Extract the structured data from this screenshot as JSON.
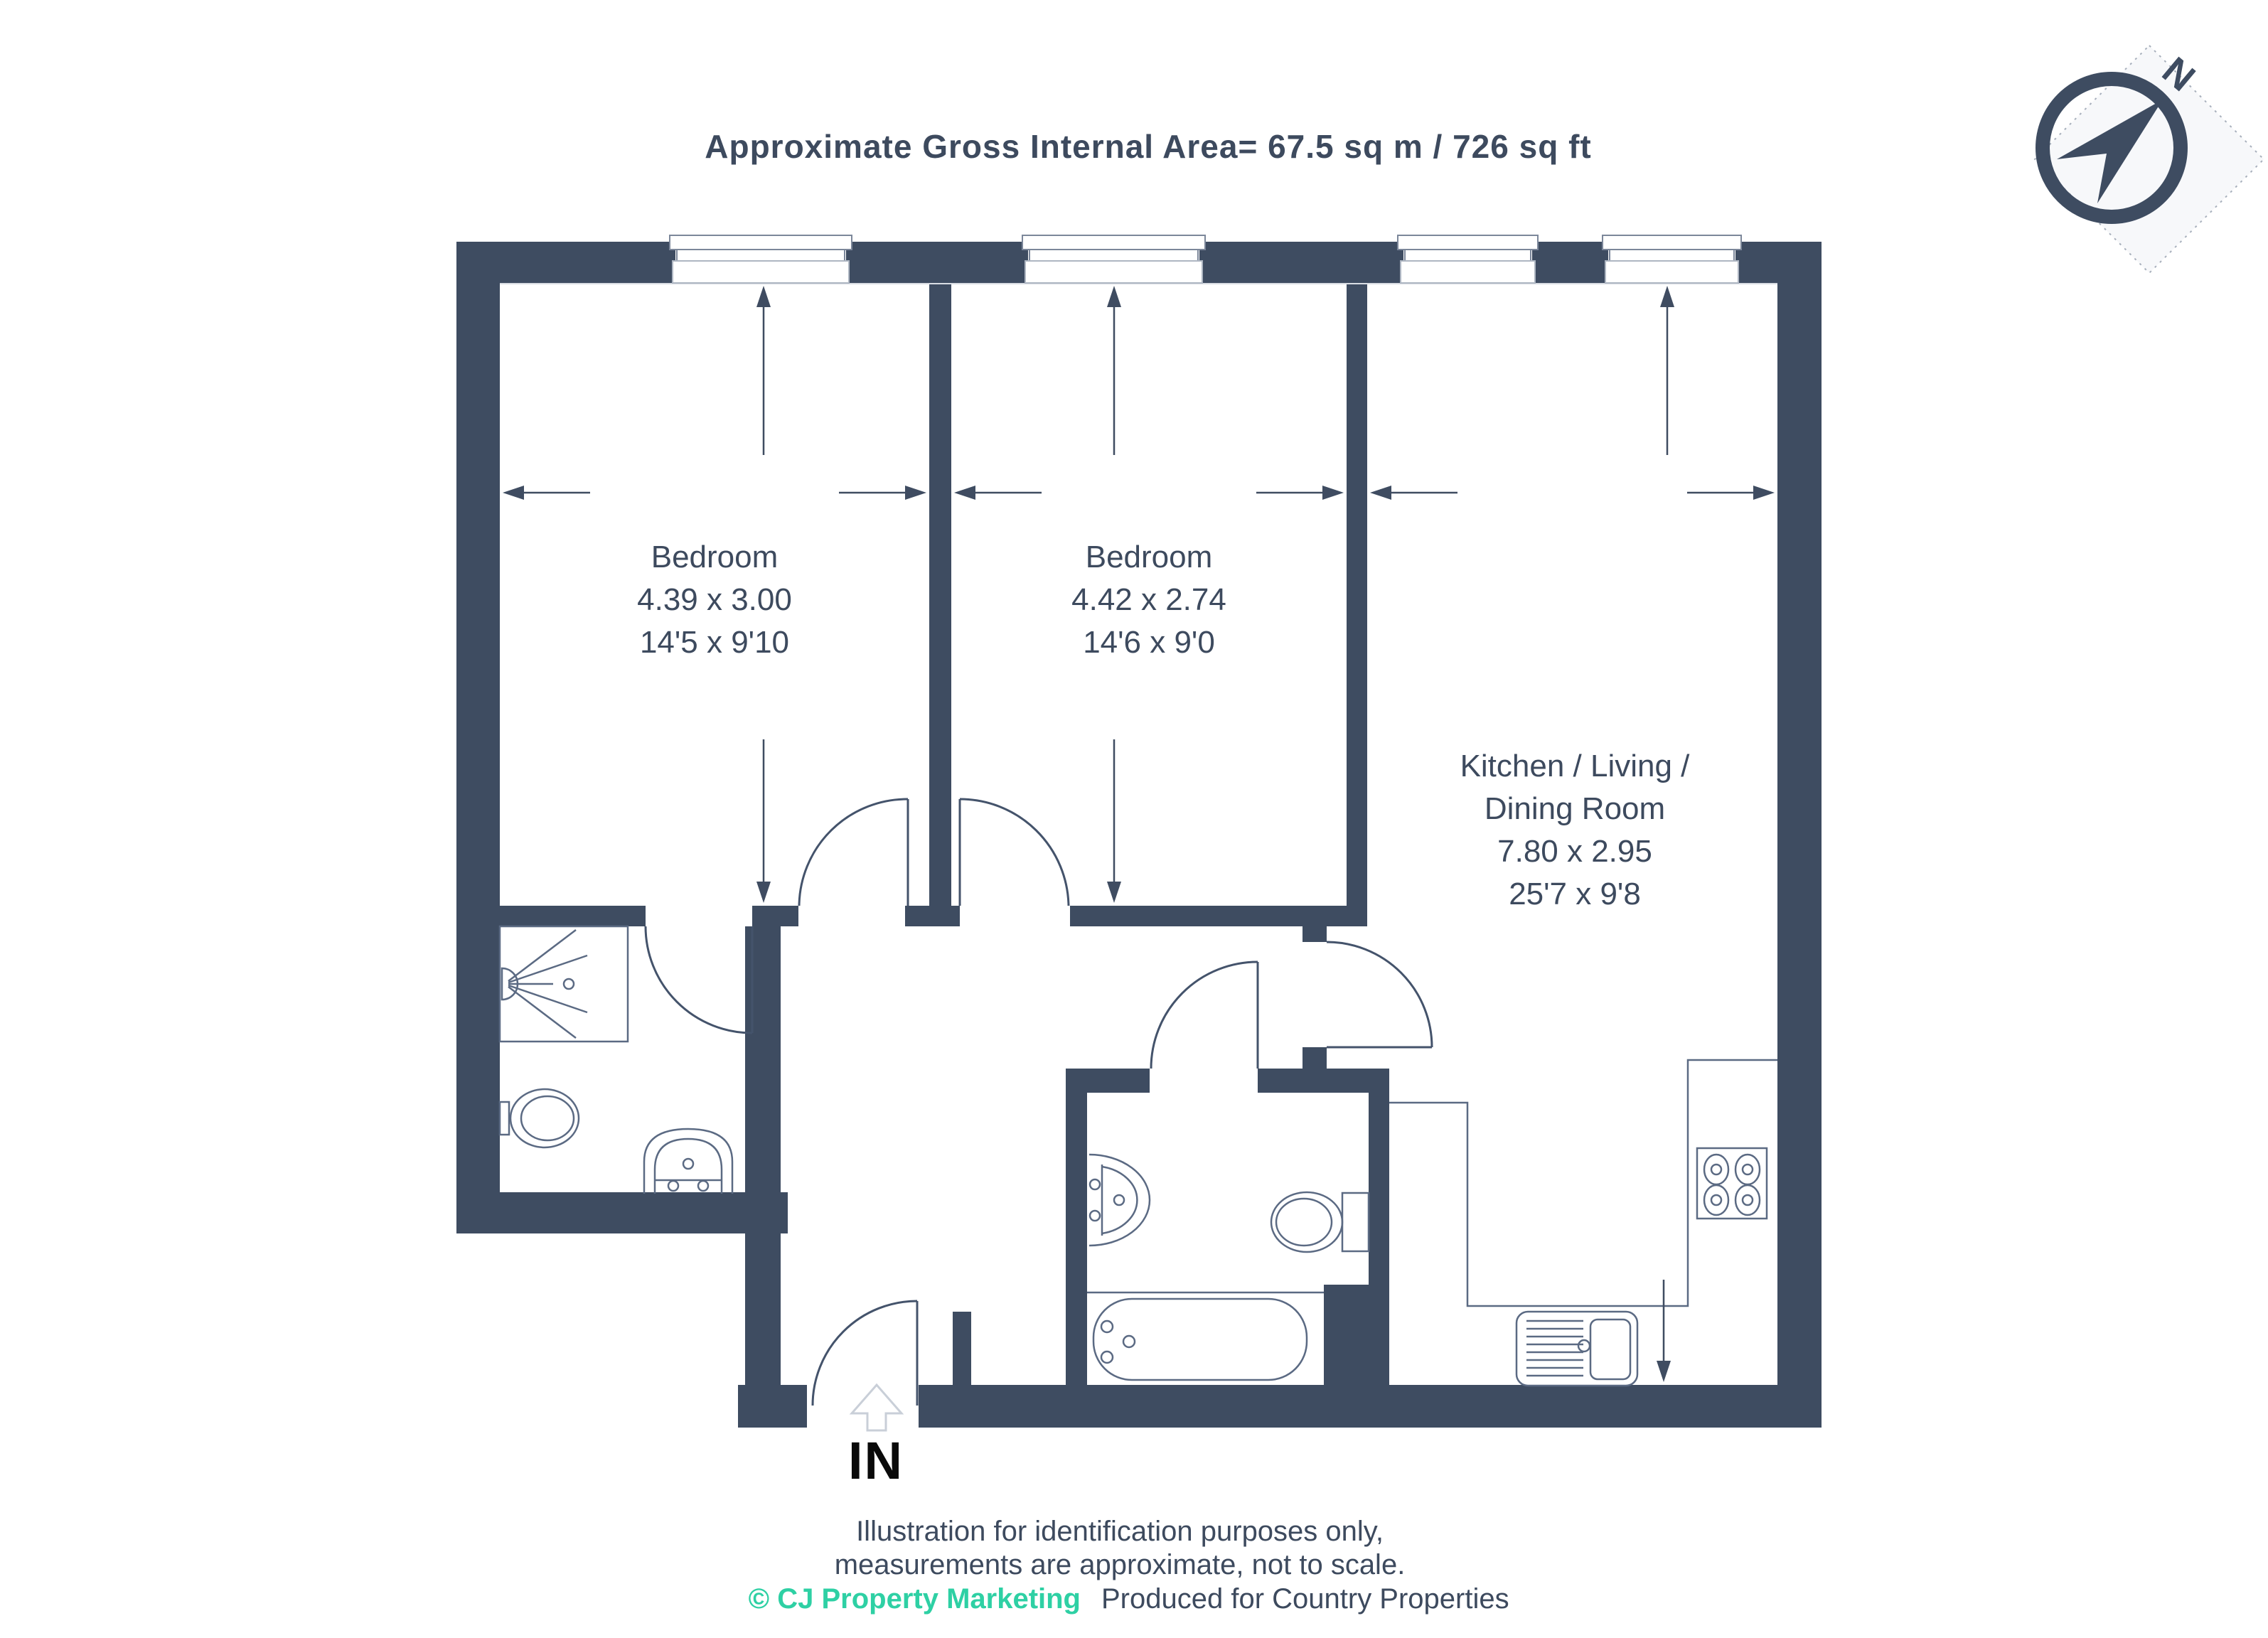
{
  "title": "Approximate Gross Internal Area= 67.5 sq m / 726 sq ft",
  "colors": {
    "wall_fill": "#3e4c61",
    "label_text": "#3d4a5e",
    "accent_teal": "#2ed0a4",
    "entrance_text": "#0a0a0a",
    "thin_line": "#5b6a83",
    "entry_arrow_gray": "#c9cfd8"
  },
  "compass": {
    "north_label": "N"
  },
  "rooms": {
    "bedroom1": {
      "name": "Bedroom",
      "metric": "4.39 x 3.00",
      "imperial": "14'5 x 9'10"
    },
    "bedroom2": {
      "name": "Bedroom",
      "metric": "4.42 x 2.74",
      "imperial": "14'6 x 9'0"
    },
    "kitchen": {
      "name_line1": "Kitchen / Living /",
      "name_line2": "Dining Room",
      "metric": "7.80 x 2.95",
      "imperial": "25'7 x 9'8"
    }
  },
  "entrance": {
    "label": "IN"
  },
  "footer": {
    "line1": "Illustration for identification purposes only,",
    "line2": "measurements are approximate, not to scale.",
    "credit_brand": "© CJ Property Marketing",
    "credit_rest": "Produced for Country Properties"
  }
}
